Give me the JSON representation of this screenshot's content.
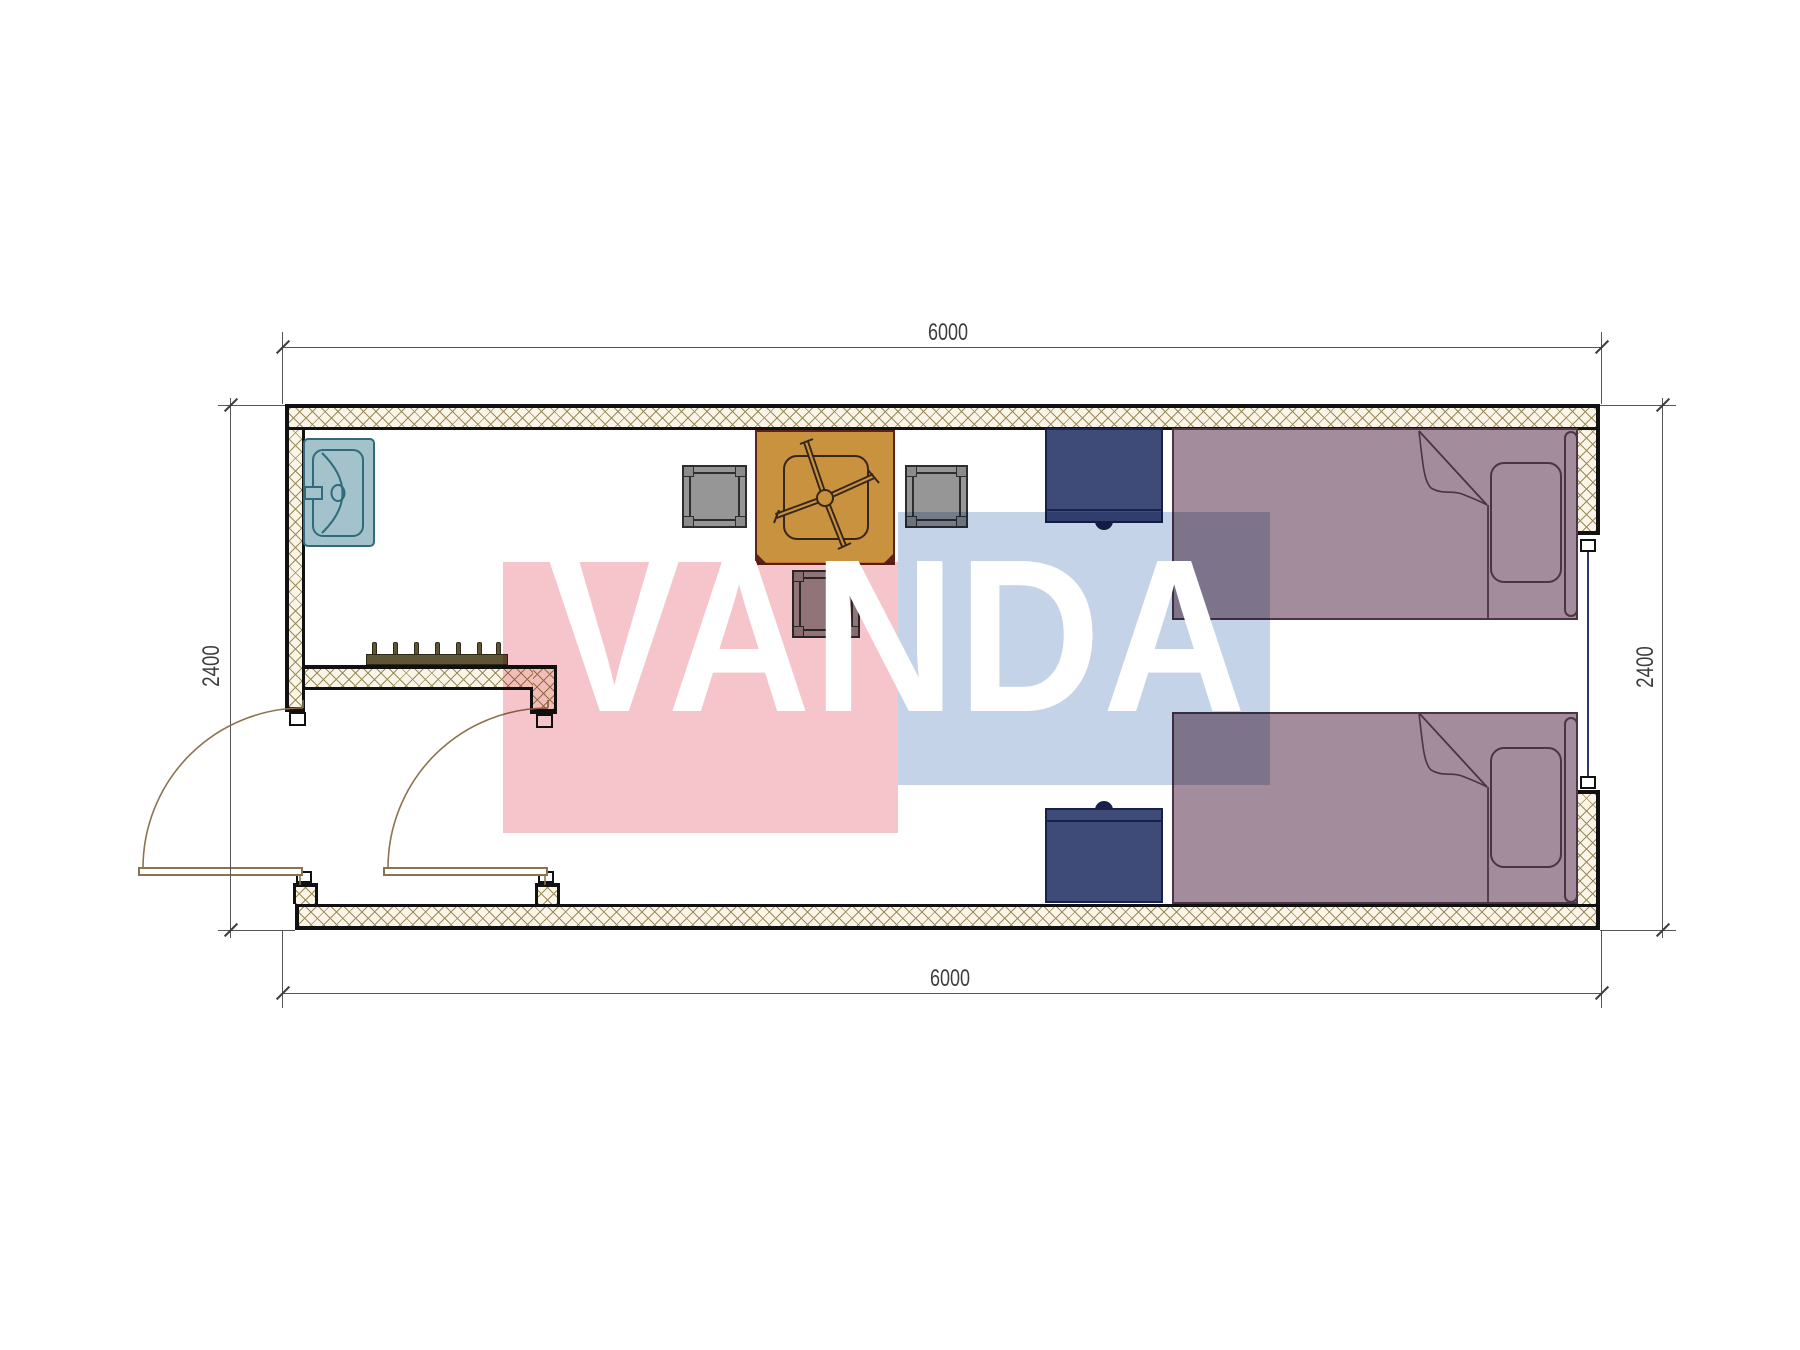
{
  "dimensions": {
    "top": "6000",
    "bottom": "6000",
    "left": "2400",
    "right": "2400"
  },
  "watermark": {
    "text": "VANDA"
  },
  "colors": {
    "paper": "#ffffff",
    "wall_line": "#111111",
    "hatch_bg": "#faf5e6",
    "hatch_line": "#9a8a5c",
    "dim_line": "#555555",
    "dim_text": "#3d3d3d",
    "door_line": "#8a7450",
    "sink_fill": "#a3c2cb",
    "sink_line": "#2f6b7a",
    "table_fill": "#c9923e",
    "table_line": "#5a241c",
    "fan_line": "#36261a",
    "stool_fill": "#969696",
    "stool_line": "#2e2e2e",
    "stool_corner": "#8b8b8b",
    "nightstand_fill": "#3e4b78",
    "nightstand_line": "#16224a",
    "bed_fill": "#a38c9b",
    "bed_line": "#4b3545",
    "window_line": "#2c3766",
    "rack_fill": "#5f5536",
    "rack_line": "#2f2a18",
    "watermark_pink": "#f6c5cb",
    "watermark_blue": "#c4d3e7",
    "watermark_text": "#ffffff"
  }
}
